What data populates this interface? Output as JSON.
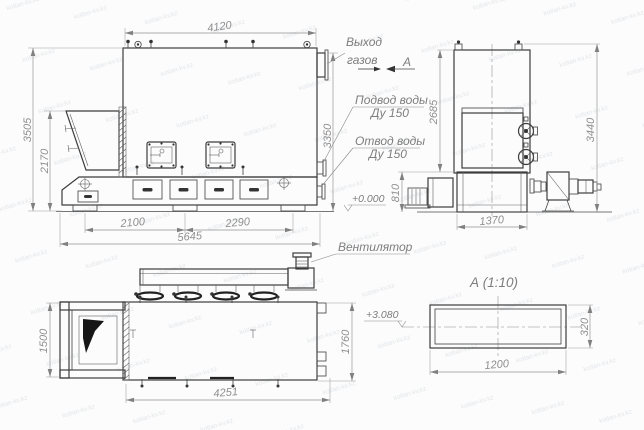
{
  "palette": {
    "ink": "#3d3d3d",
    "dim_text": "#8f8f8f",
    "paper": "#fcfcfc",
    "watermark": "#e2e5e9"
  },
  "watermark_text": "kotlan-kv.kz",
  "callouts": {
    "gas_out_line1": "Выход",
    "gas_out_line2": "газов",
    "view_letter": "А",
    "water_inlet_line1": "Подвод воды",
    "water_inlet_line2": "Ду 150",
    "water_outlet_line1": "Отвод воды",
    "water_outlet_line2": "Ду 150",
    "fan": "Вентилятор",
    "level_zero": "+0.000",
    "level_duct": "+3.080",
    "section_title": "А (1:10)"
  },
  "dims": {
    "side": {
      "top_width": "4120",
      "height_total": "3505",
      "height_hopper": "2170",
      "height_right": "3350",
      "bottom_left": "2100",
      "bottom_right": "2290",
      "bottom_total": "5645"
    },
    "front": {
      "height_body": "2685",
      "height_total": "3440",
      "height_base": "810",
      "width_base": "1370"
    },
    "top": {
      "hopper_width": "1500",
      "body_width": "1760",
      "length": "4251"
    },
    "section": {
      "width": "1200",
      "height": "320"
    }
  }
}
